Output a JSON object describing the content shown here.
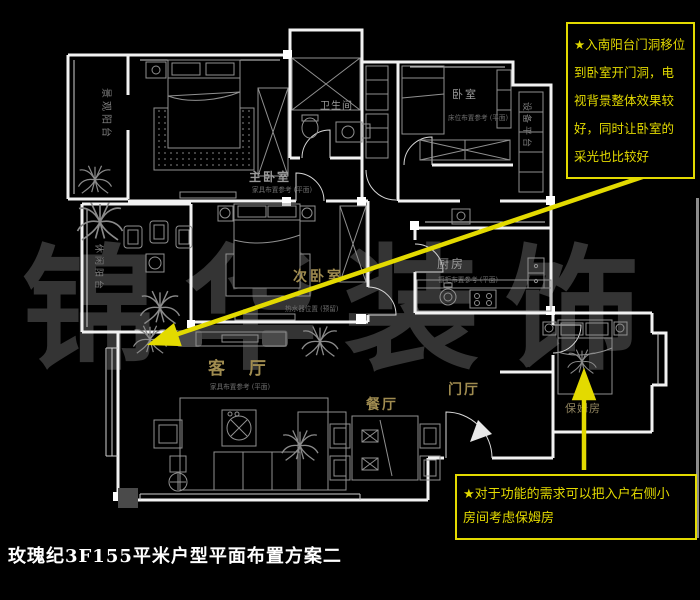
{
  "title": "玫瑰纪3F155平米户型平面布置方案二",
  "watermark": "锦华装饰",
  "notes": {
    "top": {
      "lines": [
        "★入南阳台门洞移位",
        "到卧室开门洞，电",
        "视背景整体效果较",
        "好，同时让卧室的",
        "采光也比较好"
      ]
    },
    "bottom": {
      "lines": [
        "★对于功能的需求可以把入户右侧小",
        "房间考虑保姆房"
      ]
    }
  },
  "rooms": {
    "master_bedroom": {
      "label": "主卧室",
      "note": "家具布置参考 (平面)"
    },
    "second_bedroom": {
      "label": "次卧室"
    },
    "living_room": {
      "label": "客 厅",
      "note": "家具布置参考 (平面)"
    },
    "dining_room": {
      "label": "餐厅"
    },
    "entry_hall": {
      "label": "门厅"
    },
    "kitchen": {
      "label": "厨房",
      "note": "橱柜布置参考 (平面)"
    },
    "bathroom": {
      "label": "卫生间"
    },
    "bedroom": {
      "label": "卧室",
      "note": "床位布置参考 (平面)"
    },
    "nanny_room": {
      "label": "保姆房"
    },
    "view_balcony": {
      "label": "景观阳台"
    },
    "leisure_balcony": {
      "label": "休闲阳台"
    },
    "equipment_platform": {
      "label": "设备平台"
    },
    "water_heater_note": {
      "label": "热水器位置 (预留)"
    }
  },
  "colors": {
    "background": "#000000",
    "wall_line": "#ffffff",
    "furniture_line": "#909090",
    "label_gold": "#a08c50",
    "label_gray": "#9a9a9a",
    "annotation_yellow": "#e3da00",
    "watermark_gray": "#343434"
  }
}
